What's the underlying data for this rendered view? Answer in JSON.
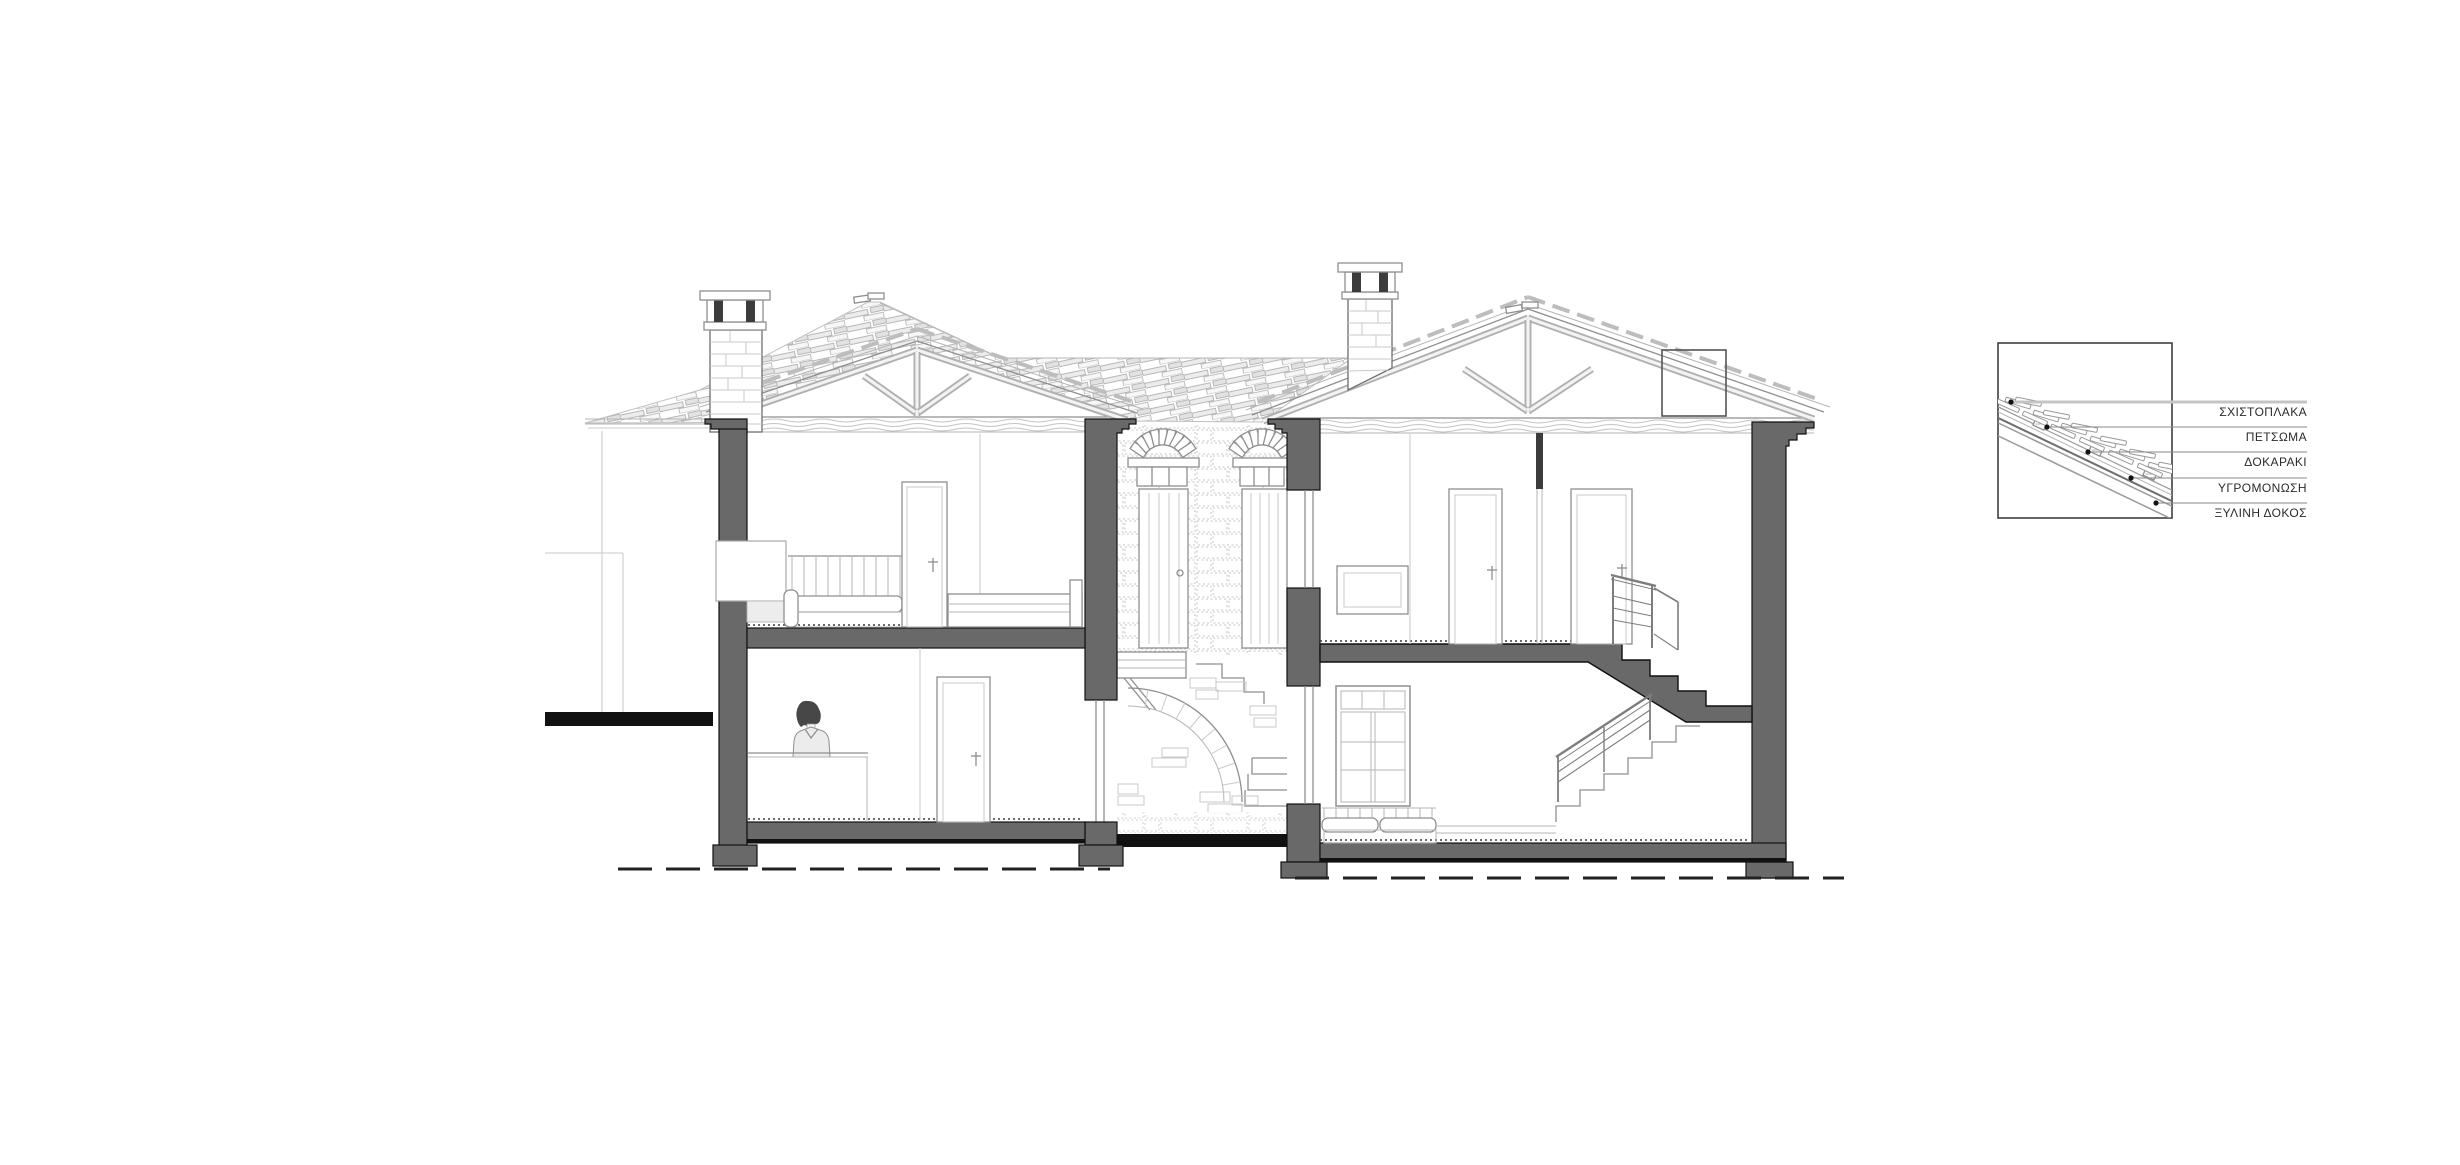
{
  "legend": {
    "labels": [
      {
        "text": "ΣΧΙΣΤΟΠΛΑΚΑ"
      },
      {
        "text": "ΠΕΤΣΩΜΑ"
      },
      {
        "text": "ΔΟΚΑΡΑΚΙ"
      },
      {
        "text": "ΥΓΡΟΜΟΝΩΣΗ"
      },
      {
        "text": "ΞΥΛΙΝΗ ΔΟΚΟΣ"
      }
    ]
  },
  "colors": {
    "paper": "#ffffff",
    "section_fill": "#696969",
    "ink": "#111111",
    "line_medium": "#8f8f8f",
    "line_light": "#c4c4c4",
    "label_text": "#2b2b2b"
  }
}
